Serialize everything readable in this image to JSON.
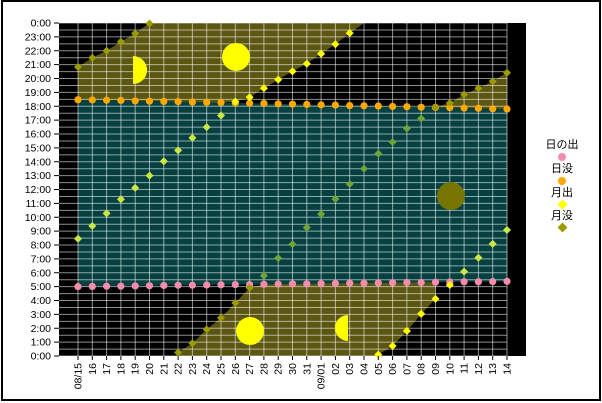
{
  "legend": {
    "items": [
      {
        "label": "日の出",
        "marker": "circle",
        "color": "#F58CAC"
      },
      {
        "label": "日没",
        "marker": "circle",
        "color": "#FFA800"
      },
      {
        "label": "月出",
        "marker": "diamond",
        "color": "#FFFF00"
      },
      {
        "label": "月没",
        "marker": "diamond",
        "color": "#9C9C00"
      }
    ]
  },
  "chart_data": {
    "type": "scatter",
    "title": "",
    "x_tick_labels": [
      "08/15",
      "16",
      "17",
      "18",
      "19",
      "20",
      "21",
      "22",
      "23",
      "24",
      "25",
      "26",
      "27",
      "28",
      "29",
      "30",
      "31",
      "09/01",
      "02",
      "03",
      "04",
      "05",
      "06",
      "07",
      "08",
      "09",
      "10",
      "11",
      "12",
      "13",
      "14"
    ],
    "y_tick_labels": [
      "0:00",
      "23:00",
      "22:00",
      "21:00",
      "20:00",
      "19:00",
      "18:00",
      "17:00",
      "16:00",
      "15:00",
      "14:00",
      "13:00",
      "12:00",
      "11:00",
      "10:00",
      "9:00",
      "8:00",
      "7:00",
      "6:00",
      "5:00",
      "4:00",
      "3:00",
      "2:00",
      "1:00",
      "0:00"
    ],
    "y_axis": {
      "bottom_hour": 0,
      "top_hour": 24,
      "label_interval_hours": 1,
      "minor_gridline_interval_hours": 0.5
    },
    "series": [
      {
        "name": "日の出",
        "marker": "circle",
        "color": "#F58CAC",
        "values": [
          "5:00",
          "5:01",
          "5:02",
          "5:02",
          "5:03",
          "5:04",
          "5:05",
          "5:06",
          "5:06",
          "5:07",
          "5:08",
          "5:09",
          "5:09",
          "5:10",
          "5:11",
          "5:12",
          "5:12",
          "5:13",
          "5:14",
          "5:15",
          "5:15",
          "5:16",
          "5:17",
          "5:18",
          "5:18",
          "5:19",
          "5:20",
          "5:21",
          "5:21",
          "5:22",
          "5:23"
        ]
      },
      {
        "name": "日没",
        "marker": "circle",
        "color": "#FFA800",
        "values": [
          "18:28",
          "18:27",
          "18:26",
          "18:25",
          "18:23",
          "18:22",
          "18:21",
          "18:20",
          "18:18",
          "18:17",
          "18:16",
          "18:14",
          "18:13",
          "18:12",
          "18:10",
          "18:09",
          "18:08",
          "18:06",
          "18:05",
          "18:03",
          "18:02",
          "18:01",
          "17:59",
          "17:58",
          "17:56",
          "17:55",
          "17:54",
          "17:52",
          "17:51",
          "17:49",
          "17:48"
        ]
      },
      {
        "name": "月出",
        "marker": "diamond",
        "color": "#FFFF00",
        "color_over_day": "#CCE645",
        "values": [
          "8:27",
          "9:22",
          "10:17",
          "11:18",
          "12:07",
          "13:00",
          "14:02",
          "14:49",
          "15:43",
          "16:30",
          "17:20",
          "18:20",
          "18:39",
          "19:18",
          "19:55",
          "20:31",
          "21:04",
          "21:47",
          "22:28",
          "23:16",
          null,
          "0:06",
          "0:43",
          "1:48",
          "3:02",
          "4:07",
          "5:07",
          "6:05",
          "7:05",
          "8:05",
          "9:05"
        ]
      },
      {
        "name": "月没",
        "marker": "diamond",
        "color": "#9C9C00",
        "color_over_day": "#6FA437",
        "values": [
          "20:50",
          "21:30",
          "22:00",
          "22:39",
          "23:15",
          "23:58",
          null,
          "0:15",
          "0:55",
          "1:55",
          "2:45",
          "3:50",
          "4:55",
          "5:47",
          "7:03",
          "8:03",
          "9:15",
          "10:14",
          "11:19",
          "12:24",
          "13:30",
          "14:35",
          "15:25",
          "16:24",
          "17:07",
          "17:56",
          "18:14",
          "18:51",
          "19:18",
          "19:48",
          "20:25"
        ]
      }
    ],
    "night_moon_regions": [
      [
        [
          0,
          18.47
        ],
        [
          1,
          18.45
        ],
        [
          2,
          18.43
        ],
        [
          3,
          18.42
        ],
        [
          4,
          18.38
        ],
        [
          5,
          18.37
        ],
        [
          6,
          18.35
        ],
        [
          7,
          18.33
        ],
        [
          8,
          18.3
        ],
        [
          9,
          18.28
        ],
        [
          10,
          18.27
        ],
        [
          11,
          18.33
        ],
        [
          12,
          18.65
        ],
        [
          13,
          19.3
        ],
        [
          14,
          19.92
        ],
        [
          15,
          20.52
        ],
        [
          16,
          21.07
        ],
        [
          17,
          21.78
        ],
        [
          18,
          22.47
        ],
        [
          19,
          23.27
        ],
        [
          20,
          24
        ],
        [
          5,
          24
        ],
        [
          4,
          23.25
        ],
        [
          3,
          22.65
        ],
        [
          2,
          22.0
        ],
        [
          1,
          21.5
        ],
        [
          0,
          20.83
        ]
      ],
      [
        [
          7,
          0
        ],
        [
          7,
          0.25
        ],
        [
          8,
          0.92
        ],
        [
          9,
          1.92
        ],
        [
          10,
          2.75
        ],
        [
          11,
          3.83
        ],
        [
          12,
          4.92
        ],
        [
          13,
          5.17
        ],
        [
          14,
          5.18
        ],
        [
          15,
          5.2
        ],
        [
          16,
          5.2
        ],
        [
          17,
          5.22
        ],
        [
          18,
          5.23
        ],
        [
          19,
          5.25
        ],
        [
          20,
          5.25
        ],
        [
          21,
          5.27
        ],
        [
          22,
          5.28
        ],
        [
          23,
          5.3
        ],
        [
          24,
          5.3
        ],
        [
          25,
          5.32
        ],
        [
          25,
          4.12
        ],
        [
          24,
          3.03
        ],
        [
          23,
          1.8
        ],
        [
          22,
          0.72
        ],
        [
          21,
          0.1
        ],
        [
          20.8,
          0
        ]
      ],
      [
        [
          25,
          17.93
        ],
        [
          26,
          18.23
        ],
        [
          27,
          18.85
        ],
        [
          28,
          19.3
        ],
        [
          29,
          19.8
        ],
        [
          30,
          20.42
        ],
        [
          30,
          17.8
        ],
        [
          29,
          17.82
        ],
        [
          28,
          17.85
        ],
        [
          27,
          17.87
        ],
        [
          26,
          17.9
        ],
        [
          25,
          17.92
        ]
      ]
    ],
    "moon_phase_icons": [
      {
        "phase": "first-quarter",
        "day": 3.85,
        "hour": 20.61,
        "r": 14,
        "color": "#FFFF00"
      },
      {
        "phase": "full",
        "day": 11.05,
        "hour": 21.55,
        "r": 14,
        "color": "#FFFF00"
      },
      {
        "phase": "full",
        "day": 12.03,
        "hour": 1.8,
        "r": 14,
        "color": "#FFFF00"
      },
      {
        "phase": "last-quarter",
        "day": 18.88,
        "hour": 2.02,
        "r": 13,
        "color": "#FFFF00"
      },
      {
        "phase": "new",
        "day": 26.08,
        "hour": 11.53,
        "r": 14,
        "color": "#757500"
      }
    ],
    "colors": {
      "plot_background": "#000000",
      "day_region": "#064040",
      "night_moon_region": "#5B5712",
      "gridline": "rgba(255,255,255,0.55)",
      "axis_text": "#000000"
    },
    "layout": {
      "plot": {
        "left": 59,
        "top": 23,
        "width": 467,
        "height": 333
      },
      "first_day_x": 78,
      "day_step": 14.3,
      "grid_right_x": 507,
      "legend_position": "right"
    }
  }
}
